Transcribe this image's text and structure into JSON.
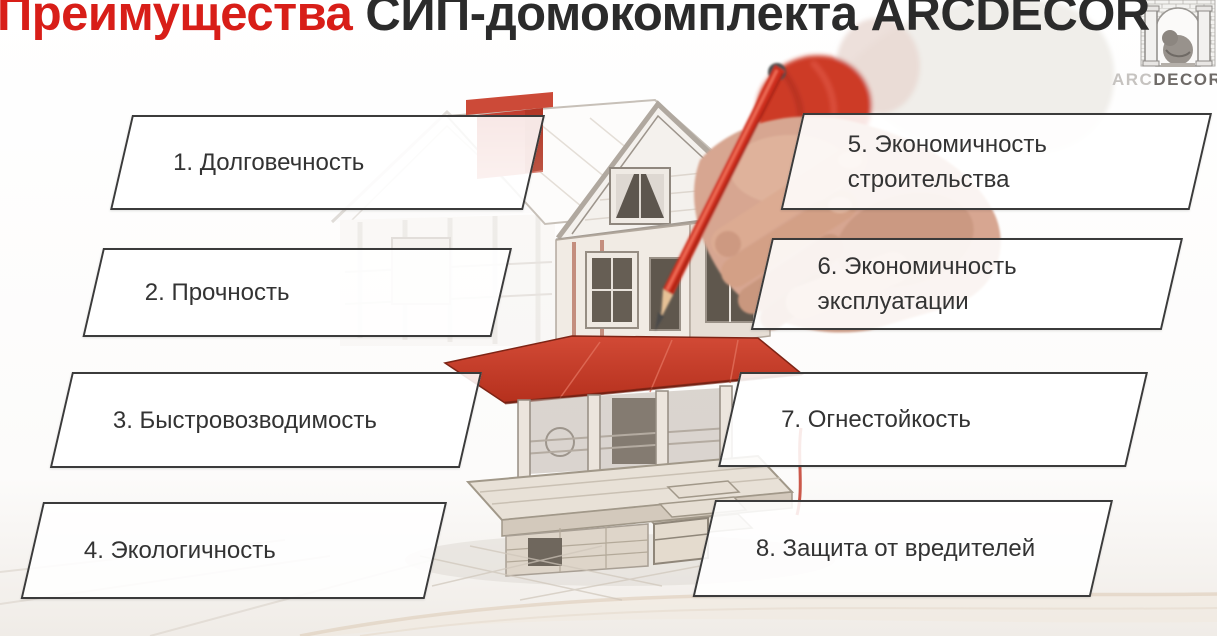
{
  "title": {
    "highlight": "Преимущества",
    "rest": " СИП-домокомплекта ARCDECOR"
  },
  "logo": {
    "arc": "ARC",
    "decor": "DECOR"
  },
  "advantages": [
    {
      "line1": "1. Долговечность"
    },
    {
      "line1": "2. Прочность"
    },
    {
      "line1": "3. Быстровозводимость"
    },
    {
      "line1": "4. Экологичность"
    },
    {
      "line1": "5. Экономичность",
      "line2": "строительства"
    },
    {
      "line1": "6. Экономичность",
      "line2": "эксплуатации"
    },
    {
      "line1": "7. Огнестойкость"
    },
    {
      "line1": "8. Защита от вредителей"
    }
  ],
  "colors": {
    "accent_red": "#d81e18",
    "title_text": "#2b2b2b",
    "box_border": "#3b3b3b",
    "box_text": "#333333",
    "sketch_gray": "#a59d94",
    "roof_red": "#c64332"
  }
}
